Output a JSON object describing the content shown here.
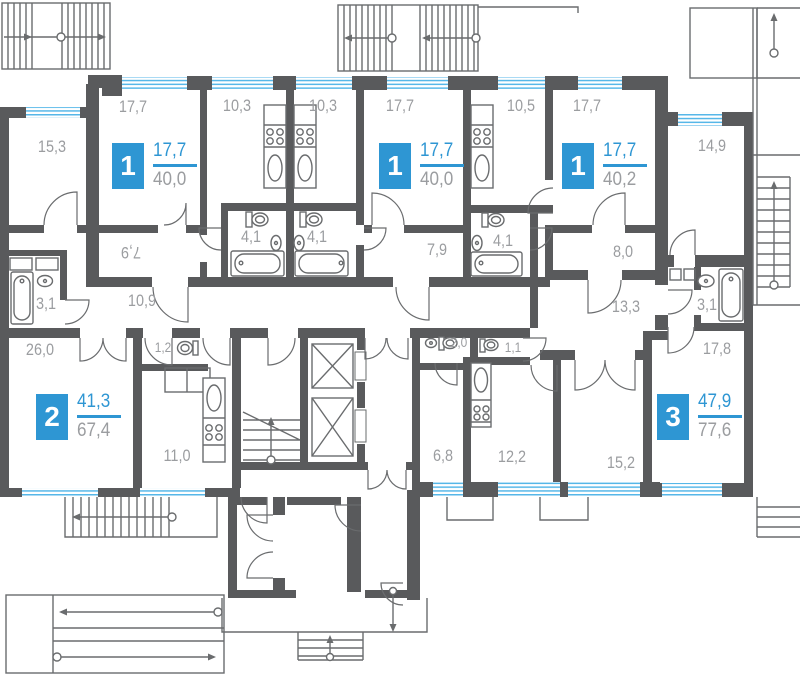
{
  "title": "Residential building floor plan",
  "colors": {
    "wall": "#595a5c",
    "window": "#56b7e8",
    "accent_blue": "#2e96d3",
    "label_gray": "#9b9da0",
    "line": "#6a6c6e"
  },
  "apartments": [
    {
      "id": "apt-1-left",
      "rooms_count": "1",
      "living_area": "17,7",
      "total_area": "40,0"
    },
    {
      "id": "apt-1-middle",
      "rooms_count": "1",
      "living_area": "17,7",
      "total_area": "40,0"
    },
    {
      "id": "apt-1-right",
      "rooms_count": "1",
      "living_area": "17,7",
      "total_area": "40,2"
    },
    {
      "id": "apt-2",
      "rooms_count": "2",
      "living_area": "41,3",
      "total_area": "67,4"
    },
    {
      "id": "apt-3",
      "rooms_count": "3",
      "living_area": "47,9",
      "total_area": "77,6"
    }
  ],
  "room_labels": [
    {
      "room": "bedroom",
      "area": "15,3"
    },
    {
      "room": "living-room",
      "area": "17,7"
    },
    {
      "room": "kitchen",
      "area": "10,3"
    },
    {
      "room": "kitchen",
      "area": "10,3"
    },
    {
      "room": "living-room",
      "area": "17,7"
    },
    {
      "room": "kitchen",
      "area": "10,5"
    },
    {
      "room": "living-room",
      "area": "17,7"
    },
    {
      "room": "bedroom",
      "area": "14,9"
    },
    {
      "room": "hallway",
      "area": "7,9"
    },
    {
      "room": "bathroom",
      "area": "4,1"
    },
    {
      "room": "bathroom",
      "area": "4,1"
    },
    {
      "room": "hallway",
      "area": "7,9"
    },
    {
      "room": "bathroom",
      "area": "4,1"
    },
    {
      "room": "hallway",
      "area": "8,0"
    },
    {
      "room": "bathroom",
      "area": "3,1"
    },
    {
      "room": "corridor",
      "area": "10,9"
    },
    {
      "room": "corridor",
      "area": "13,3"
    },
    {
      "room": "bathroom",
      "area": "3,1"
    },
    {
      "room": "living-room",
      "area": "26,0"
    },
    {
      "room": "wc",
      "area": "1,2"
    },
    {
      "room": "wc",
      "area": "2,0"
    },
    {
      "room": "wc",
      "area": "1,1"
    },
    {
      "room": "living-room",
      "area": "17,8"
    },
    {
      "room": "kitchen",
      "area": "11,0"
    },
    {
      "room": "hallway",
      "area": "6,8"
    },
    {
      "room": "kitchen",
      "area": "12,2"
    },
    {
      "room": "bedroom",
      "area": "15,2"
    }
  ]
}
